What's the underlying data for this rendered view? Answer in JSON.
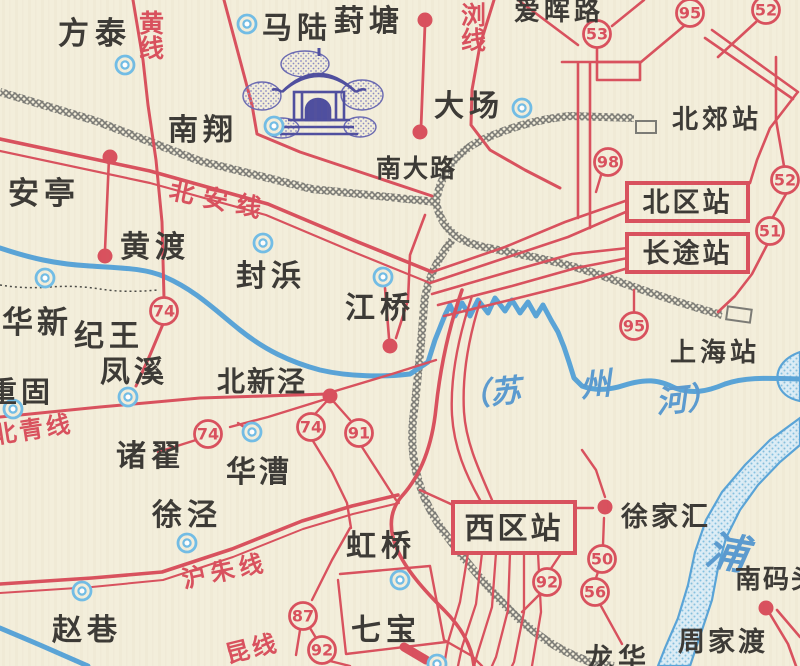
{
  "map_type": "scanned-transit-suburban-map",
  "colors": {
    "paper": "#f3eedb",
    "route_red": "#d9515e",
    "river_blue": "#59a4d8",
    "water_fill": "#dcedf6",
    "water_dot": "#85c0e0",
    "rail_gray": "#7b7b76",
    "ink_dark": "#3c3a36",
    "town_ring_blue": "#72bde6",
    "water_text_blue": "#5b9bd0",
    "landmark_indigo": "#5454a2"
  },
  "town_labels": [
    {
      "text": "方泰",
      "x": 58,
      "y": 44,
      "size": 31,
      "spacing": 6
    },
    {
      "text": "马陆",
      "x": 262,
      "y": 38,
      "size": 30,
      "spacing": 5
    },
    {
      "text": "葑塘",
      "x": 334,
      "y": 31,
      "size": 30,
      "spacing": 5
    },
    {
      "text": "大场",
      "x": 434,
      "y": 116,
      "size": 30,
      "spacing": 5
    },
    {
      "text": "南翔",
      "x": 168,
      "y": 140,
      "size": 30,
      "spacing": 5
    },
    {
      "text": "南大路",
      "x": 376,
      "y": 177,
      "size": 25,
      "spacing": 2
    },
    {
      "text": "安亭",
      "x": 8,
      "y": 204,
      "size": 31,
      "spacing": 5
    },
    {
      "text": "黄渡",
      "x": 120,
      "y": 257,
      "size": 30,
      "spacing": 5
    },
    {
      "text": "封浜",
      "x": 236,
      "y": 286,
      "size": 30,
      "spacing": 5
    },
    {
      "text": "江桥",
      "x": 345,
      "y": 318,
      "size": 30,
      "spacing": 5
    },
    {
      "text": "北郊站",
      "x": 672,
      "y": 128,
      "size": 26,
      "spacing": 4
    },
    {
      "text": "上海站",
      "x": 670,
      "y": 361,
      "size": 26,
      "spacing": 4
    },
    {
      "text": "华新",
      "x": 2,
      "y": 333,
      "size": 31,
      "spacing": 4
    },
    {
      "text": "纪王",
      "x": 74,
      "y": 346,
      "size": 30,
      "spacing": 5
    },
    {
      "text": "凤溪",
      "x": 100,
      "y": 382,
      "size": 30,
      "spacing": 4
    },
    {
      "text": "重固",
      "x": -12,
      "y": 402,
      "size": 29,
      "spacing": 4
    },
    {
      "text": "北新泾",
      "x": 217,
      "y": 391,
      "size": 28,
      "spacing": 2
    },
    {
      "text": "诸翟",
      "x": 116,
      "y": 466,
      "size": 30,
      "spacing": 5
    },
    {
      "text": "华漕",
      "x": 226,
      "y": 482,
      "size": 30,
      "spacing": 3
    },
    {
      "text": "徐泾",
      "x": 152,
      "y": 525,
      "size": 30,
      "spacing": 5
    },
    {
      "text": "赵巷",
      "x": 52,
      "y": 640,
      "size": 30,
      "spacing": 5
    },
    {
      "text": "虹桥",
      "x": 346,
      "y": 556,
      "size": 30,
      "spacing": 5
    },
    {
      "text": "七宝",
      "x": 351,
      "y": 640,
      "size": 30,
      "spacing": 5
    },
    {
      "text": "徐家汇",
      "x": 621,
      "y": 526,
      "size": 27,
      "spacing": 3
    },
    {
      "text": "龙华",
      "x": 585,
      "y": 668,
      "size": 28,
      "spacing": 5
    },
    {
      "text": "周家渡",
      "x": 678,
      "y": 651,
      "size": 27,
      "spacing": 3
    },
    {
      "text": "南码头",
      "x": 735,
      "y": 588,
      "size": 26,
      "spacing": 2
    },
    {
      "text": "爱晖路",
      "x": 514,
      "y": 20,
      "size": 26,
      "spacing": 4
    }
  ],
  "water_labels": [
    {
      "text": "（苏",
      "x": 460,
      "y": 407,
      "size": 31,
      "rotate": -6
    },
    {
      "text": "州",
      "x": 581,
      "y": 397,
      "size": 31,
      "rotate": -6
    },
    {
      "text": "河）",
      "x": 657,
      "y": 413,
      "size": 31,
      "rotate": -6
    },
    {
      "text": "浦",
      "x": 704,
      "y": 563,
      "size": 41,
      "rotate": 10
    }
  ],
  "route_line_labels": [
    {
      "text": "北安线",
      "x": 168,
      "y": 198,
      "size": 25,
      "rotate": 12,
      "spacing": 9
    },
    {
      "text": "黄线",
      "x": 150,
      "y": 10,
      "size": 25,
      "vertical": true
    },
    {
      "text": "浏线",
      "x": 472,
      "y": 2,
      "size": 25,
      "vertical": true
    },
    {
      "text": "北青线",
      "x": -6,
      "y": 444,
      "size": 24,
      "rotate": -9,
      "spacing": 3
    },
    {
      "text": "沪朱线",
      "x": 184,
      "y": 588,
      "size": 24,
      "rotate": -12,
      "spacing": 5
    },
    {
      "text": "昆线",
      "x": 228,
      "y": 663,
      "size": 24,
      "rotate": -14,
      "spacing": 3
    }
  ],
  "stations_boxed": [
    {
      "label": "北区站",
      "x": 627,
      "y": 183,
      "w": 121,
      "h": 38,
      "size": 27
    },
    {
      "label": "长途站",
      "x": 627,
      "y": 234,
      "w": 121,
      "h": 38,
      "size": 27
    },
    {
      "label": "西区站",
      "x": 453,
      "y": 502,
      "w": 122,
      "h": 51,
      "size": 30
    }
  ],
  "route_badges": [
    {
      "num": "53",
      "x": 597,
      "y": 34
    },
    {
      "num": "95",
      "x": 690,
      "y": 13
    },
    {
      "num": "52",
      "x": 766,
      "y": 10
    },
    {
      "num": "98",
      "x": 608,
      "y": 162
    },
    {
      "num": "52",
      "x": 785,
      "y": 180
    },
    {
      "num": "51",
      "x": 770,
      "y": 231
    },
    {
      "num": "95",
      "x": 634,
      "y": 326
    },
    {
      "num": "74",
      "x": 164,
      "y": 311
    },
    {
      "num": "74",
      "x": 208,
      "y": 434
    },
    {
      "num": "74",
      "x": 311,
      "y": 427
    },
    {
      "num": "91",
      "x": 359,
      "y": 433
    },
    {
      "num": "87",
      "x": 303,
      "y": 616
    },
    {
      "num": "92",
      "x": 322,
      "y": 650
    },
    {
      "num": "50",
      "x": 602,
      "y": 559
    },
    {
      "num": "92",
      "x": 547,
      "y": 582
    },
    {
      "num": "56",
      "x": 595,
      "y": 592
    }
  ],
  "town_markers": [
    {
      "x": 125,
      "y": 65
    },
    {
      "x": 247,
      "y": 24
    },
    {
      "x": 522,
      "y": 108
    },
    {
      "x": 274,
      "y": 126
    },
    {
      "x": 45,
      "y": 278
    },
    {
      "x": 263,
      "y": 243
    },
    {
      "x": 383,
      "y": 277
    },
    {
      "x": 128,
      "y": 397
    },
    {
      "x": 13,
      "y": 409
    },
    {
      "x": 252,
      "y": 432
    },
    {
      "x": 187,
      "y": 543
    },
    {
      "x": 82,
      "y": 591
    },
    {
      "x": 400,
      "y": 580
    },
    {
      "x": 437,
      "y": 664
    }
  ],
  "stop_dots": [
    {
      "x": 110,
      "y": 157
    },
    {
      "x": 425,
      "y": 20
    },
    {
      "x": 420,
      "y": 132
    },
    {
      "x": 105,
      "y": 256
    },
    {
      "x": 390,
      "y": 346
    },
    {
      "x": 330,
      "y": 396
    },
    {
      "x": 605,
      "y": 507
    },
    {
      "x": 766,
      "y": 608
    }
  ]
}
